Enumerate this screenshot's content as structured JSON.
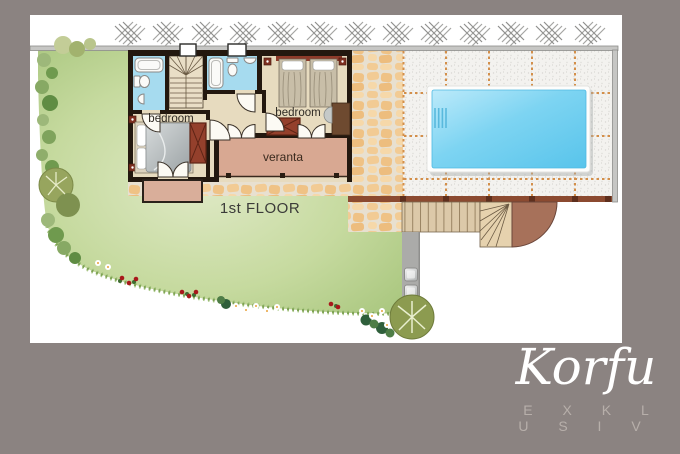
{
  "plan": {
    "floor_label": "1st FLOOR",
    "rooms": {
      "bedroom_left": "bedroom",
      "bedroom_right": "bedroom",
      "veranda": "veranta"
    }
  },
  "brand": {
    "name": "Korfu",
    "tagline": "E X K L U S I V"
  },
  "colors": {
    "background": "#8B8381",
    "canvas": "#FFFFFF",
    "lawn": "#C6DA9F",
    "pool_water": "#6FCDEF",
    "veranda_floor": "#D8A892",
    "bathroom_floor": "#A6DBEF",
    "furniture_accent": "#94402C",
    "stone_path": "#F2CB94",
    "patio_tile_joint": "#D28A42",
    "wood_deck": "#DCC9A9",
    "terrace_edge": "#8B4A30",
    "wall": "#23180F",
    "boundary_wall": "#C6C6C4",
    "brand_text": "#FFFFFF",
    "tagline_text": "#B7AFAA"
  }
}
